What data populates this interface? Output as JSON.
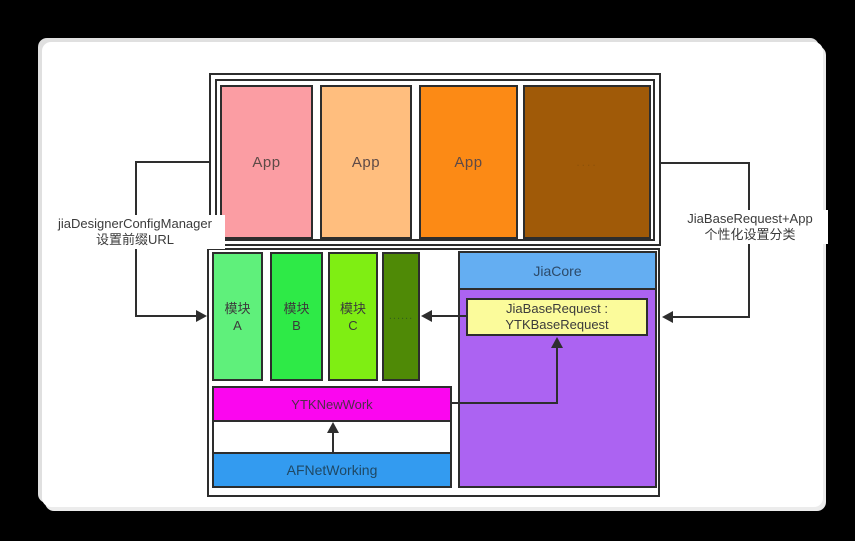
{
  "app_layer": {
    "boxes": [
      {
        "label": "App",
        "bg": "#fb9da3",
        "fg": "#5e4a47"
      },
      {
        "label": "App",
        "bg": "#ffbe7e",
        "fg": "#5e4a47"
      },
      {
        "label": "App",
        "bg": "#fc8a15",
        "fg": "#5e4a47"
      },
      {
        "label": "....",
        "bg": "#a05a08",
        "fg": "#7c4a0a"
      }
    ]
  },
  "modules": {
    "boxes": [
      {
        "line1": "模块",
        "line2": "A",
        "bg": "#5ff07b",
        "fg": "#3b3b3b"
      },
      {
        "line1": "模块",
        "line2": "B",
        "bg": "#2eea47",
        "fg": "#3b3b3b"
      },
      {
        "line1": "模块",
        "line2": "C",
        "bg": "#7fee13",
        "fg": "#3b3b3b"
      },
      {
        "line1": "......",
        "line2": "",
        "bg": "#4f8a06",
        "fg": "#33601c"
      }
    ]
  },
  "stack": {
    "ytknewwork": {
      "label": "YTKNewWork",
      "bg": "#fb06ef",
      "fg": "#4f2d49"
    },
    "afnetworking": {
      "label": "AFNetWorking",
      "bg": "#339bf0",
      "fg": "#1f4864"
    }
  },
  "core": {
    "header": {
      "label": "JiaCore",
      "bg": "#64aef2",
      "fg": "#2c4a69"
    },
    "body_bg": "#ac63f2",
    "request": {
      "line1": "JiaBaseRequest :",
      "line2": "YTKBaseRequest",
      "bg": "#fbfb9b",
      "fg": "#3b3b3b"
    }
  },
  "annotations": {
    "left": {
      "line1": "jiaDesignerConfigManager",
      "line2": "设置前缀URL"
    },
    "right": {
      "line1": "JiaBaseRequest+App",
      "line2": "个性化设置分类"
    }
  }
}
